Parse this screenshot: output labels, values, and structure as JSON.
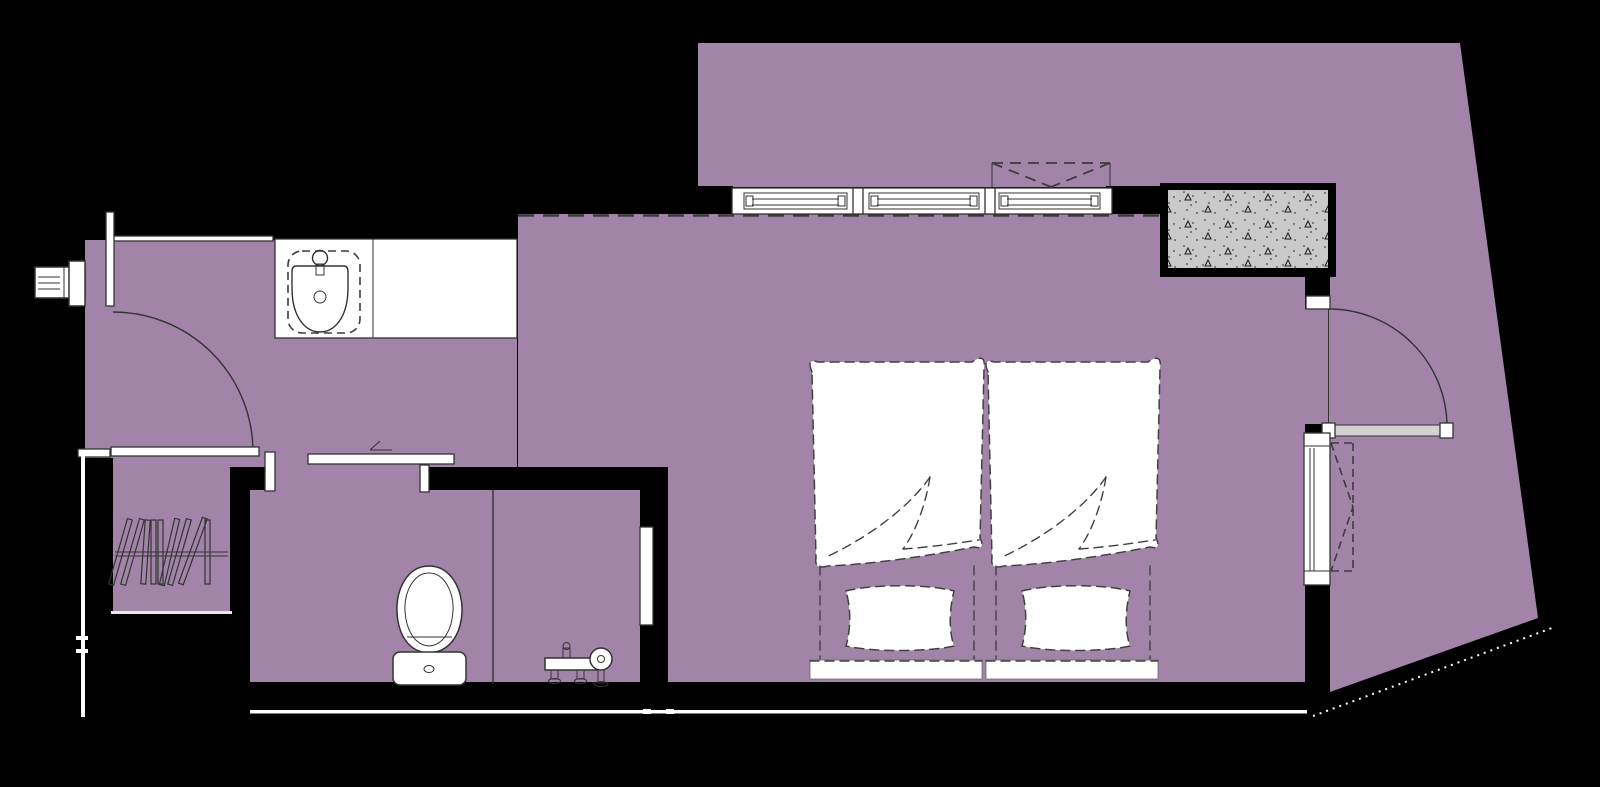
{
  "meta": {
    "type": "architectural-floor-plan",
    "view": "top-down",
    "width_px": 1600,
    "height_px": 787,
    "visible_text": "none"
  },
  "palette": {
    "background": "#000000",
    "floor": "#a284a8",
    "wall": "#000000",
    "line": "#333333",
    "white": "#ffffff",
    "concrete_fill": "#c9c9c9",
    "concrete_mark": "#1a1a1a",
    "door_leaf": "#d2d2d2"
  },
  "fixtures": [
    "entry-door-swing",
    "wall-vent-panel",
    "washbasin-counter",
    "coat-rail-with-hangers",
    "sliding-door",
    "toilet",
    "shower-mixer",
    "shower-screen",
    "triple-window-band",
    "overhead-cabinet-dashed",
    "concrete-shaft-hatched",
    "room-door-swing",
    "casement-window",
    "twin-bed-left",
    "twin-bed-right"
  ],
  "counts": {
    "beds": 2,
    "pillows": 2,
    "window_panels": 3,
    "doors": 3,
    "hangers": 9
  }
}
